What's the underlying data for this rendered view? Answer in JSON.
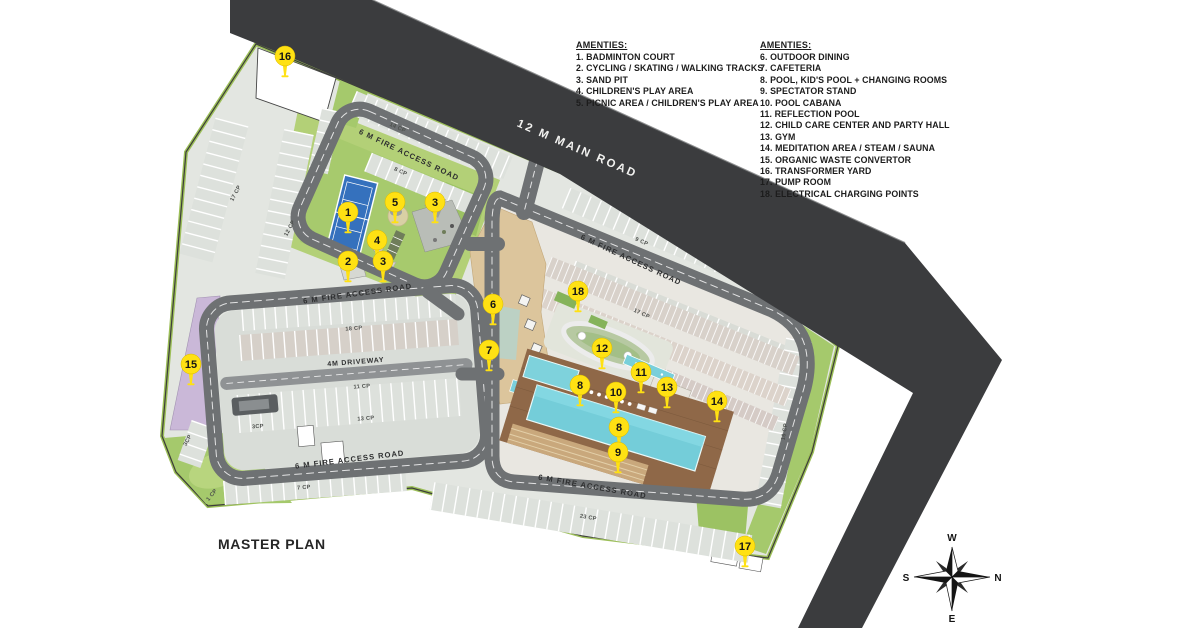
{
  "title": "MASTER PLAN",
  "amenities_left": {
    "heading": "AMENTIES:",
    "items": [
      "1. BADMINTON COURT",
      "2. CYCLING / SKATING / WALKING TRACKS",
      "3. SAND PIT",
      "4. CHILDREN'S PLAY AREA",
      "5. PICNIC AREA / CHILDREN'S PLAY AREA"
    ]
  },
  "amenities_right": {
    "heading": "AMENTIES:",
    "items": [
      "6. OUTDOOR DINING",
      "7. CAFETERIA",
      "8. POOL, KID'S POOL + CHANGING ROOMS",
      "9. SPECTATOR STAND",
      "10. POOL CABANA",
      "11. REFLECTION POOL",
      "12. CHILD CARE CENTER AND PARTY HALL",
      "13. GYM",
      "14. MEDITATION AREA / STEAM / SAUNA",
      "15. ORGANIC WASTE CONVERTOR",
      "16. TRANSFORMER YARD",
      "17. PUMP ROOM",
      "18. ELECTRICAL CHARGING POINTS"
    ]
  },
  "road_labels": {
    "main_road": "12 M MAIN ROAD",
    "fire_access": "6 M FIRE ACCESS ROAD",
    "driveway": "4M DRIVEWAY"
  },
  "parking_labels": [
    "14 CP",
    "8 CP",
    "17 CP",
    "12 CP",
    "9 CP",
    "17 CP",
    "18 CP",
    "11 CP",
    "13 CP",
    "3CP",
    "3CP",
    "7 CP",
    "1 CP",
    "16 CP",
    "23 CP"
  ],
  "markers": [
    "16",
    "1",
    "5",
    "3",
    "4",
    "2",
    "3",
    "15",
    "6",
    "7",
    "18",
    "12",
    "11",
    "8",
    "10",
    "13",
    "14",
    "8",
    "9",
    "17"
  ],
  "compass": {
    "n": "N",
    "s": "S",
    "e": "E",
    "w": "W"
  },
  "colors": {
    "asphalt": "#3b3c3e",
    "inner_road": "#6e7173",
    "grass": "#a5c96c",
    "parking": "#dde1dc",
    "pool": "#74cdd9",
    "deck": "#8f6848",
    "clubhouse": "#dcc59c",
    "marker": "#ffe113",
    "organic_strip": "#cab8d8",
    "court": "#3571bd"
  }
}
